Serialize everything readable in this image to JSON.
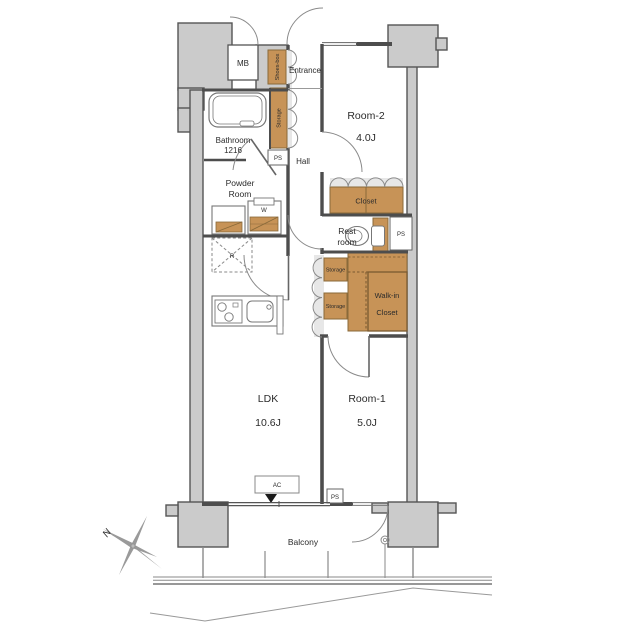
{
  "plan_title": "apartment-floor-plan",
  "colors": {
    "structure_gray": "#cbcbcb",
    "wall_dark": "#4d4d4d",
    "storage_tan": "#c79357",
    "storage_border": "#8a6a3a",
    "thin_line": "#8a8a8a"
  },
  "rooms": {
    "room2": {
      "name": "Room-2",
      "size": "4.0J"
    },
    "room1": {
      "name": "Room-1",
      "size": "5.0J"
    },
    "ldk": {
      "name": "LDK",
      "size": "10.6J"
    },
    "bathroom": {
      "name": "Bathroom",
      "size": "1216"
    },
    "powder_room": {
      "line1": "Powder",
      "line2": "Room"
    },
    "rest_room": {
      "line1": "Rest",
      "line2": "room"
    },
    "walk_in_closet": {
      "line1": "Walk-in",
      "line2": "Closet"
    },
    "hall": {
      "name": "Hall"
    },
    "entrance": {
      "name": "Entrance"
    },
    "balcony": {
      "name": "Balcony"
    }
  },
  "storage": {
    "closet": "Closet",
    "shoes_box": "Shoes-box",
    "hall_storage": "Storage",
    "storage_1": "Storage",
    "storage_2": "Storage"
  },
  "fixtures": {
    "mb": "MB",
    "ps": "PS",
    "washer": "W",
    "refrigerator": "R",
    "ac": "AC"
  },
  "compass": {
    "north": "N"
  }
}
